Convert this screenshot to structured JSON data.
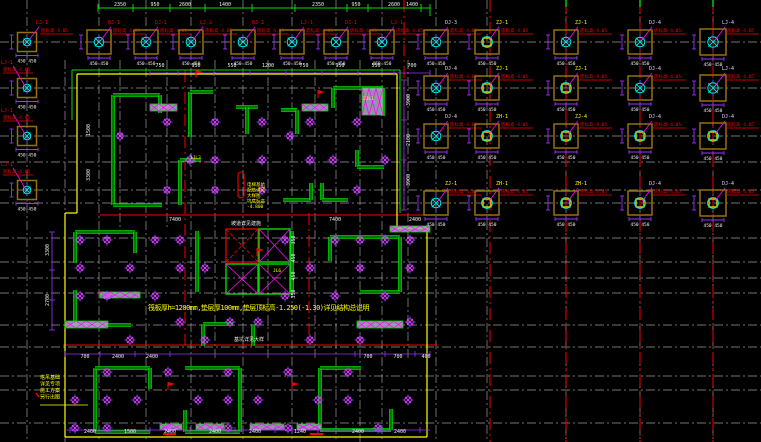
{
  "drawing": {
    "type": "cad-foundation-plan",
    "canvas": {
      "w": 761,
      "h": 442
    }
  },
  "colors": {
    "bg": "#000000",
    "grid": "#9a9a9a",
    "axis_red": "#fa0000",
    "cap_brown": "#96700a",
    "pile_cyan": "#00e8e8",
    "tick_blue": "#4455ff",
    "wall_green": "#00dc00",
    "boundary_yellow": "#ffff00",
    "dim_purple": "#9933ff",
    "leader_magenta": "#ff00ff",
    "hatch_fill": "#b4a8cc",
    "text_white": "#f0f0f0",
    "label_white": "#dcd2ff",
    "label_yellow": "#ffff00",
    "label_red": "#fa0000",
    "note_yellow": "#ffff00"
  },
  "grid": {
    "v": [
      [
        27,
        0,
        442
      ],
      [
        99,
        0,
        442
      ],
      [
        146,
        0,
        442
      ],
      [
        191,
        0,
        442
      ],
      [
        243,
        0,
        442
      ],
      [
        292,
        0,
        442
      ],
      [
        336,
        0,
        442
      ],
      [
        382,
        0,
        442
      ],
      [
        436,
        0,
        442
      ],
      [
        487,
        0,
        442
      ],
      [
        566,
        0,
        442
      ],
      [
        640,
        0,
        442
      ],
      [
        713,
        0,
        442
      ],
      [
        65,
        60,
        442
      ],
      [
        120,
        60,
        230
      ],
      [
        167,
        60,
        230
      ],
      [
        215,
        60,
        360
      ],
      [
        268,
        60,
        360
      ],
      [
        315,
        60,
        360
      ],
      [
        360,
        60,
        442
      ],
      [
        408,
        60,
        360
      ]
    ],
    "h": [
      [
        42,
        0,
        761
      ],
      [
        88,
        0,
        761
      ],
      [
        136,
        0,
        761
      ],
      [
        162,
        0,
        761
      ],
      [
        190,
        0,
        761
      ],
      [
        203,
        0,
        761
      ],
      [
        238,
        0,
        761
      ],
      [
        262,
        0,
        761
      ],
      [
        278,
        0,
        761
      ],
      [
        293,
        0,
        761
      ],
      [
        325,
        0,
        761
      ],
      [
        347,
        0,
        761
      ],
      [
        376,
        0,
        761
      ],
      [
        390,
        0,
        761
      ],
      [
        423,
        0,
        761
      ]
    ]
  },
  "red_axes": {
    "v": [
      [
        404,
        0,
        215
      ],
      [
        490,
        0,
        442
      ],
      [
        566,
        0,
        442
      ],
      [
        640,
        0,
        442
      ],
      [
        713,
        0,
        442
      ],
      [
        185,
        70,
        345
      ],
      [
        309,
        213,
        345
      ]
    ],
    "h": [
      [
        215,
        100,
        437
      ],
      [
        345,
        63,
        437
      ]
    ],
    "marks": [
      [
        434,
        163,
        176
      ],
      [
        434,
        310,
        323
      ]
    ]
  },
  "green_ticks": [
    566,
    640,
    713
  ],
  "top_dim": {
    "y": 8,
    "x1": 98,
    "x2": 430,
    "ticks": [
      98,
      133,
      170,
      205,
      252,
      295,
      347,
      368,
      421,
      430
    ],
    "labels": [
      [
        120,
        "2350"
      ],
      [
        155,
        "950"
      ],
      [
        185,
        "2600"
      ],
      [
        225,
        "1400"
      ],
      [
        318,
        "2350"
      ],
      [
        356,
        "950"
      ],
      [
        394,
        "2600"
      ],
      [
        412,
        "1400"
      ]
    ]
  },
  "boundary": {
    "yellow": [
      [
        77,
        74,
        397,
        74
      ],
      [
        77,
        74,
        77,
        213
      ],
      [
        65,
        213,
        77,
        213
      ],
      [
        65,
        213,
        65,
        437
      ],
      [
        65,
        437,
        427,
        437
      ],
      [
        427,
        228,
        427,
        437
      ],
      [
        397,
        228,
        427,
        228
      ],
      [
        397,
        74,
        397,
        228
      ]
    ],
    "green": [
      [
        72,
        70,
        400,
        70
      ],
      [
        400,
        70,
        400,
        213
      ],
      [
        72,
        70,
        72,
        120
      ],
      [
        430,
        8,
        430,
        16
      ]
    ]
  },
  "walls": [
    [
      113,
      95,
      113,
      205
    ],
    [
      113,
      95,
      160,
      95
    ],
    [
      160,
      95,
      160,
      113
    ],
    [
      113,
      205,
      162,
      205
    ],
    [
      190,
      92,
      190,
      137
    ],
    [
      190,
      92,
      213,
      92
    ],
    [
      236,
      107,
      258,
      107
    ],
    [
      247,
      107,
      247,
      134
    ],
    [
      281,
      110,
      297,
      110
    ],
    [
      297,
      110,
      297,
      134
    ],
    [
      333,
      88,
      383,
      88
    ],
    [
      333,
      88,
      333,
      108
    ],
    [
      383,
      88,
      383,
      116
    ],
    [
      357,
      150,
      357,
      167
    ],
    [
      357,
      167,
      384,
      167
    ],
    [
      180,
      160,
      180,
      205
    ],
    [
      180,
      160,
      201,
      160
    ],
    [
      283,
      200,
      311,
      200
    ],
    [
      311,
      183,
      311,
      200
    ],
    [
      322,
      183,
      322,
      200
    ],
    [
      322,
      200,
      348,
      200
    ],
    [
      75,
      232,
      135,
      232
    ],
    [
      75,
      232,
      75,
      263
    ],
    [
      135,
      232,
      135,
      253
    ],
    [
      75,
      290,
      75,
      325
    ],
    [
      75,
      325,
      131,
      325
    ],
    [
      197,
      231,
      197,
      292
    ],
    [
      292,
      231,
      292,
      292
    ],
    [
      330,
      237,
      400,
      237
    ],
    [
      330,
      237,
      330,
      261
    ],
    [
      400,
      237,
      400,
      292
    ],
    [
      360,
      292,
      400,
      292
    ],
    [
      203,
      324,
      233,
      324
    ],
    [
      203,
      324,
      203,
      346
    ],
    [
      253,
      324,
      253,
      346
    ],
    [
      95,
      368,
      95,
      432
    ],
    [
      95,
      368,
      150,
      368
    ],
    [
      150,
      368,
      150,
      389
    ],
    [
      95,
      432,
      150,
      432
    ],
    [
      185,
      368,
      240,
      368
    ],
    [
      240,
      368,
      240,
      432
    ],
    [
      185,
      410,
      185,
      432
    ],
    [
      185,
      432,
      240,
      432
    ],
    [
      320,
      368,
      320,
      430
    ],
    [
      320,
      368,
      361,
      368
    ],
    [
      320,
      430,
      391,
      430
    ],
    [
      391,
      409,
      391,
      430
    ]
  ],
  "pits": {
    "red": [
      226,
      229,
      32,
      33
    ],
    "green": [
      [
        259,
        229,
        31,
        33
      ],
      [
        259,
        264,
        31,
        30
      ],
      [
        226,
        264,
        32,
        30
      ]
    ]
  },
  "red_capsule": [
    238,
    172,
    6,
    26
  ],
  "hatched_beams": [
    [
      150,
      104,
      27,
      7
    ],
    [
      302,
      104,
      26,
      7
    ],
    [
      362,
      88,
      21,
      27
    ],
    [
      65,
      321,
      43,
      7
    ],
    [
      357,
      321,
      46,
      7
    ],
    [
      160,
      424,
      22,
      6
    ],
    [
      196,
      424,
      28,
      6
    ],
    [
      250,
      424,
      34,
      6
    ],
    [
      297,
      424,
      24,
      6
    ],
    [
      100,
      292,
      40,
      6
    ],
    [
      390,
      226,
      40,
      6
    ]
  ],
  "caps": [
    [
      27,
      42,
      19,
      "LJ-1",
      "r",
      "f"
    ],
    [
      99,
      42,
      24,
      "DJ-1",
      "r",
      "f"
    ],
    [
      146,
      42,
      24,
      "DJ-1",
      "r",
      "f"
    ],
    [
      191,
      42,
      24,
      "LJ-2",
      "r",
      "f"
    ],
    [
      243,
      42,
      24,
      "DJ-2",
      "r",
      "f"
    ],
    [
      292,
      42,
      24,
      "LJ-1",
      "r",
      "f"
    ],
    [
      336,
      42,
      24,
      "DJ-1",
      "r",
      "f"
    ],
    [
      382,
      42,
      24,
      "LJ-1",
      "r",
      "f"
    ],
    [
      436,
      42,
      24,
      "DJ-3",
      "w",
      "f"
    ],
    [
      487,
      42,
      24,
      "ZJ-1",
      "y",
      "s"
    ],
    [
      566,
      42,
      24,
      "ZJ-1",
      "y",
      "f"
    ],
    [
      640,
      42,
      24,
      "DJ-4",
      "w",
      "f"
    ],
    [
      713,
      42,
      26,
      "LJ-4",
      "w",
      "f"
    ],
    [
      27,
      88,
      19,
      "LJ-1",
      "r",
      "f"
    ],
    [
      436,
      88,
      24,
      "DJ-4",
      "w",
      "f"
    ],
    [
      487,
      88,
      24,
      "ZJ-1",
      "y",
      "s"
    ],
    [
      566,
      88,
      24,
      "ZJ-1",
      "y",
      "s"
    ],
    [
      640,
      88,
      24,
      "DJ-4",
      "w",
      "f"
    ],
    [
      713,
      88,
      26,
      "LJ-4",
      "w",
      "f"
    ],
    [
      27,
      136,
      19,
      "LJ-1",
      "r",
      "f"
    ],
    [
      436,
      136,
      24,
      "DJ-4",
      "w",
      "f"
    ],
    [
      487,
      136,
      24,
      "ZH-1",
      "y",
      "s"
    ],
    [
      566,
      136,
      24,
      "ZJ-4",
      "y",
      "s"
    ],
    [
      640,
      136,
      24,
      "DJ-4",
      "w",
      "s"
    ],
    [
      713,
      136,
      26,
      "DJ-4",
      "w",
      "s"
    ],
    [
      27,
      190,
      19,
      "LJ-1",
      "r",
      "f"
    ],
    [
      436,
      203,
      24,
      "ZJ-1",
      "y",
      "f"
    ],
    [
      487,
      203,
      24,
      "ZH-1",
      "y",
      "s"
    ],
    [
      566,
      203,
      24,
      "ZH-1",
      "y",
      "s"
    ],
    [
      640,
      203,
      24,
      "DJ-4",
      "w",
      "s"
    ],
    [
      713,
      203,
      26,
      "DJ-4",
      "w",
      "s"
    ]
  ],
  "cap_elev_text": "底标高-4.05",
  "cap_dim_text": "450 450",
  "piles": [
    [
      120,
      136
    ],
    [
      167,
      122
    ],
    [
      167,
      190
    ],
    [
      215,
      122
    ],
    [
      215,
      160
    ],
    [
      215,
      190
    ],
    [
      262,
      122
    ],
    [
      262,
      160
    ],
    [
      262,
      190
    ],
    [
      310,
      122
    ],
    [
      310,
      160
    ],
    [
      333,
      160
    ],
    [
      357,
      122
    ],
    [
      357,
      190
    ],
    [
      385,
      160
    ],
    [
      290,
      136
    ],
    [
      190,
      160
    ],
    [
      80,
      240
    ],
    [
      80,
      268
    ],
    [
      80,
      296
    ],
    [
      107,
      240
    ],
    [
      107,
      296
    ],
    [
      130,
      268
    ],
    [
      155,
      240
    ],
    [
      155,
      296
    ],
    [
      180,
      240
    ],
    [
      180,
      268
    ],
    [
      180,
      322
    ],
    [
      205,
      268
    ],
    [
      230,
      322
    ],
    [
      258,
      322
    ],
    [
      285,
      240
    ],
    [
      285,
      296
    ],
    [
      310,
      268
    ],
    [
      335,
      240
    ],
    [
      335,
      296
    ],
    [
      360,
      240
    ],
    [
      360,
      268
    ],
    [
      385,
      240
    ],
    [
      385,
      296
    ],
    [
      410,
      240
    ],
    [
      410,
      268
    ],
    [
      410,
      322
    ],
    [
      130,
      340
    ],
    [
      205,
      340
    ],
    [
      310,
      340
    ],
    [
      360,
      340
    ],
    [
      75,
      400
    ],
    [
      75,
      428
    ],
    [
      107,
      372
    ],
    [
      107,
      400
    ],
    [
      107,
      428
    ],
    [
      137,
      400
    ],
    [
      168,
      372
    ],
    [
      168,
      428
    ],
    [
      198,
      400
    ],
    [
      228,
      372
    ],
    [
      228,
      400
    ],
    [
      228,
      428
    ],
    [
      258,
      400
    ],
    [
      288,
      372
    ],
    [
      288,
      428
    ],
    [
      318,
      400
    ],
    [
      348,
      372
    ],
    [
      348,
      400
    ],
    [
      378,
      428
    ],
    [
      408,
      400
    ]
  ],
  "dims": [
    [
      160,
      67,
      "750",
      0
    ],
    [
      196,
      67,
      "950",
      0
    ],
    [
      232,
      67,
      "550",
      0
    ],
    [
      268,
      67,
      "1200",
      0
    ],
    [
      304,
      67,
      "750",
      0
    ],
    [
      340,
      67,
      "950",
      0
    ],
    [
      376,
      67,
      "550",
      0
    ],
    [
      412,
      67,
      "700",
      0
    ],
    [
      175,
      221,
      "7400",
      0
    ],
    [
      335,
      221,
      "7400",
      0
    ],
    [
      415,
      221,
      "2400",
      0
    ],
    [
      85,
      358,
      "700",
      0
    ],
    [
      118,
      358,
      "2400",
      0
    ],
    [
      152,
      358,
      "2400",
      0
    ],
    [
      368,
      358,
      "700",
      0
    ],
    [
      398,
      358,
      "700",
      0
    ],
    [
      426,
      358,
      "400",
      0
    ],
    [
      90,
      433,
      "2400",
      0
    ],
    [
      130,
      433,
      "1500",
      0
    ],
    [
      170,
      433,
      "2400",
      0
    ],
    [
      215,
      433,
      "2400",
      0
    ],
    [
      255,
      433,
      "2400",
      0
    ],
    [
      300,
      433,
      "1240",
      0
    ],
    [
      358,
      433,
      "2400",
      0
    ],
    [
      400,
      433,
      "2400",
      0
    ],
    [
      295,
      240,
      "350",
      1
    ],
    [
      295,
      258,
      "450",
      1
    ],
    [
      295,
      276,
      "450",
      1
    ],
    [
      295,
      294,
      "350",
      1
    ],
    [
      410,
      100,
      "3900",
      1
    ],
    [
      410,
      140,
      "2100",
      1
    ],
    [
      410,
      180,
      "3900",
      1
    ],
    [
      49,
      250,
      "3300",
      1
    ],
    [
      49,
      300,
      "2700",
      1
    ],
    [
      90,
      130,
      "1500",
      1
    ],
    [
      90,
      175,
      "3300",
      1
    ]
  ],
  "dim_chains": [
    {
      "type": "h",
      "y": 73,
      "x1": 150,
      "x2": 430,
      "ticks": [
        150,
        178,
        214,
        250,
        286,
        322,
        358,
        394,
        430
      ]
    },
    {
      "type": "h",
      "y": 354,
      "x1": 65,
      "x2": 430,
      "ticks": [
        65,
        100,
        135,
        170,
        355,
        385,
        415,
        430
      ]
    },
    {
      "type": "h",
      "y": 430,
      "x1": 65,
      "x2": 430,
      "ticks": [
        70,
        110,
        150,
        190,
        235,
        275,
        318,
        380,
        420
      ]
    },
    {
      "type": "v",
      "x": 52,
      "y1": 232,
      "y2": 330,
      "ticks": [
        232,
        270,
        300,
        330
      ]
    },
    {
      "type": "v",
      "x": 404,
      "y1": 80,
      "y2": 210,
      "ticks": [
        80,
        120,
        160,
        210
      ]
    }
  ],
  "notes": {
    "main": {
      "x": 148,
      "y": 310,
      "t": "筏板厚h=1200mm,垫层厚100mm,垫层顶标高-1.250(-1.30)详见结构总说明"
    },
    "block_core": {
      "x": 247,
      "y": 186,
      "lines": [
        "电梯基坑",
        "配筋详见",
        "大样图",
        "坑底标高",
        "-4.800"
      ]
    },
    "block_left": {
      "x": 40,
      "y": 379,
      "lines": [
        "塔吊基础",
        "详见专项",
        "施工方案",
        "另行出图"
      ]
    },
    "small_yellow": [
      [
        363,
        100,
        "2JL1"
      ],
      [
        190,
        159,
        "1JL3"
      ],
      [
        273,
        272,
        "JL6"
      ]
    ],
    "small_white": [
      [
        231,
        225,
        "坡道详见建施"
      ],
      [
        234,
        341,
        "基坑详见大样"
      ]
    ]
  },
  "flags": [
    [
      196,
      78
    ],
    [
      318,
      98
    ],
    [
      257,
      256
    ],
    [
      168,
      390
    ],
    [
      292,
      390
    ]
  ]
}
